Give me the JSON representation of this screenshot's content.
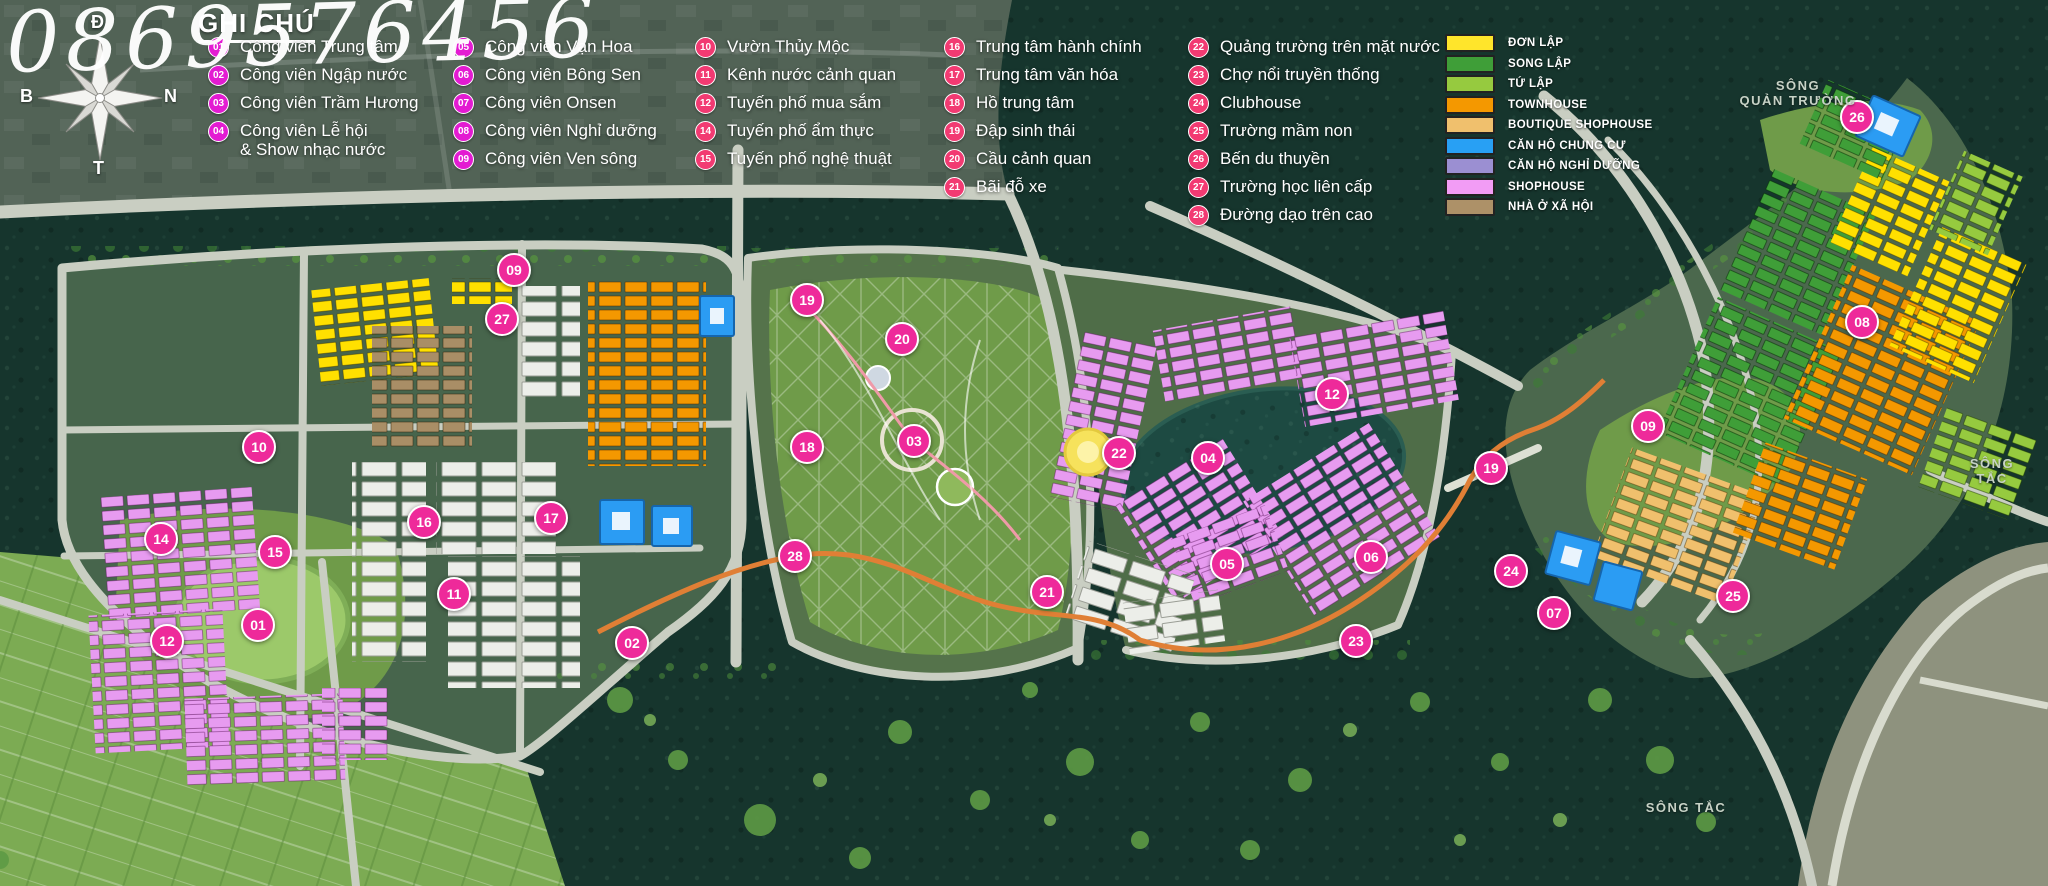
{
  "watermark": "0869576456",
  "compass": {
    "top": "Đ",
    "left": "B",
    "right": "N",
    "bottom": "T"
  },
  "legend": {
    "title": "GHI CHÚ",
    "circle_color_parks": "#e31bd2",
    "circle_color_other": "#f23a72",
    "columns": [
      {
        "items": [
          {
            "num": "01",
            "label": "Công viên Trung tâm"
          },
          {
            "num": "02",
            "label": "Công viên Ngập nước"
          },
          {
            "num": "03",
            "label": "Công viên Trầm Hương"
          },
          {
            "num": "04",
            "label": "Công viên Lễ hội\n& Show nhạc nước"
          }
        ]
      },
      {
        "items": [
          {
            "num": "05",
            "label": "Công viên Vạn Hoa"
          },
          {
            "num": "06",
            "label": "Công viên Bông Sen"
          },
          {
            "num": "07",
            "label": "Công viên Onsen"
          },
          {
            "num": "08",
            "label": "Công viên Nghỉ dưỡng"
          },
          {
            "num": "09",
            "label": "Công viên Ven sông"
          }
        ]
      },
      {
        "items": [
          {
            "num": "10",
            "label": "Vườn Thủy Mộc"
          },
          {
            "num": "11",
            "label": "Kênh nước cảnh quan"
          },
          {
            "num": "12",
            "label": "Tuyến phố mua sắm"
          },
          {
            "num": "14",
            "label": "Tuyến phố ẩm thực"
          },
          {
            "num": "15",
            "label": "Tuyến phố nghệ thuật"
          }
        ]
      },
      {
        "items": [
          {
            "num": "16",
            "label": "Trung tâm hành chính"
          },
          {
            "num": "17",
            "label": "Trung tâm văn hóa"
          },
          {
            "num": "18",
            "label": "Hồ trung tâm"
          },
          {
            "num": "19",
            "label": "Đập sinh thái"
          },
          {
            "num": "20",
            "label": "Cầu cảnh quan"
          },
          {
            "num": "21",
            "label": "Bãi đỗ xe"
          }
        ]
      },
      {
        "items": [
          {
            "num": "22",
            "label": "Quảng trường trên mặt nước"
          },
          {
            "num": "23",
            "label": "Chợ nổi truyền thống"
          },
          {
            "num": "24",
            "label": "Clubhouse"
          },
          {
            "num": "25",
            "label": "Trường mầm non"
          },
          {
            "num": "26",
            "label": "Bến du thuyền"
          },
          {
            "num": "27",
            "label": "Trường học liên cấp"
          },
          {
            "num": "28",
            "label": "Đường dạo trên cao"
          }
        ]
      }
    ]
  },
  "color_legend": {
    "items": [
      {
        "label": "ĐƠN LẬP",
        "color": "#ffe52b"
      },
      {
        "label": "SONG LẬP",
        "color": "#3f9e38"
      },
      {
        "label": "TỨ LẬP",
        "color": "#96ca3f"
      },
      {
        "label": "TOWNHOUSE",
        "color": "#f49800"
      },
      {
        "label": "BOUTIQUE SHOPHOUSE",
        "color": "#f0c06d"
      },
      {
        "label": "CĂN HỘ CHUNG CƯ",
        "color": "#28a0f4"
      },
      {
        "label": "CĂN HỘ NGHỈ DƯỠNG",
        "color": "#9b8fd2"
      },
      {
        "label": "SHOPHOUSE",
        "color": "#f29cf5"
      },
      {
        "label": "NHÀ Ở XÃ HỘI",
        "color": "#ad9168"
      }
    ]
  },
  "map": {
    "marker_color": "#ee2a9a",
    "labels": [
      {
        "text": "SÔNG\nQUẢN TRƯỜNG",
        "x": 1798,
        "y": 78
      },
      {
        "text": "SÔNG TẮC",
        "x": 1992,
        "y": 456
      },
      {
        "text": "SÔNG TẮC",
        "x": 1686,
        "y": 800
      }
    ],
    "markers": [
      {
        "num": "09",
        "x": 512,
        "y": 268
      },
      {
        "num": "27",
        "x": 500,
        "y": 317
      },
      {
        "num": "10",
        "x": 257,
        "y": 445
      },
      {
        "num": "14",
        "x": 159,
        "y": 537
      },
      {
        "num": "15",
        "x": 273,
        "y": 550
      },
      {
        "num": "16",
        "x": 422,
        "y": 520
      },
      {
        "num": "17",
        "x": 549,
        "y": 516
      },
      {
        "num": "11",
        "x": 452,
        "y": 592
      },
      {
        "num": "01",
        "x": 256,
        "y": 623
      },
      {
        "num": "12",
        "x": 165,
        "y": 639
      },
      {
        "num": "02",
        "x": 630,
        "y": 641
      },
      {
        "num": "19",
        "x": 805,
        "y": 298
      },
      {
        "num": "20",
        "x": 900,
        "y": 337
      },
      {
        "num": "18",
        "x": 805,
        "y": 445
      },
      {
        "num": "03",
        "x": 912,
        "y": 439
      },
      {
        "num": "28",
        "x": 793,
        "y": 554
      },
      {
        "num": "22",
        "x": 1117,
        "y": 451
      },
      {
        "num": "04",
        "x": 1206,
        "y": 456
      },
      {
        "num": "05",
        "x": 1225,
        "y": 562
      },
      {
        "num": "21",
        "x": 1045,
        "y": 590
      },
      {
        "num": "06",
        "x": 1369,
        "y": 555
      },
      {
        "num": "23",
        "x": 1354,
        "y": 639
      },
      {
        "num": "12",
        "x": 1330,
        "y": 392
      },
      {
        "num": "19",
        "x": 1489,
        "y": 466
      },
      {
        "num": "24",
        "x": 1509,
        "y": 569
      },
      {
        "num": "07",
        "x": 1552,
        "y": 611
      },
      {
        "num": "25",
        "x": 1731,
        "y": 594
      },
      {
        "num": "09",
        "x": 1646,
        "y": 424
      },
      {
        "num": "08",
        "x": 1860,
        "y": 320
      },
      {
        "num": "26",
        "x": 1855,
        "y": 115
      }
    ]
  }
}
